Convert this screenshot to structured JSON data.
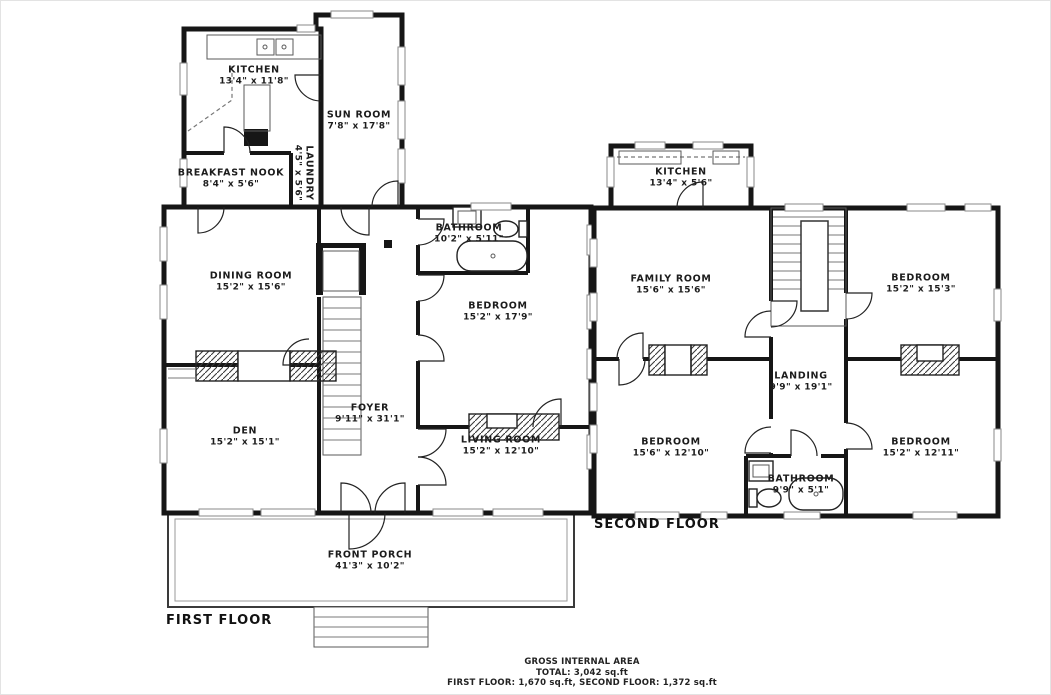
{
  "first_floor": {
    "label": "FIRST FLOOR",
    "rooms": [
      {
        "name": "KITCHEN",
        "dims": "13'4\" x 11'8\""
      },
      {
        "name": "SUN ROOM",
        "dims": "7'8\" x 17'8\""
      },
      {
        "name": "BREAKFAST NOOK",
        "dims": "8'4\" x 5'6\""
      },
      {
        "name": "LAUNDRY",
        "dims": "4'5\" x 5'6\""
      },
      {
        "name": "DINING ROOM",
        "dims": "15'2\" x 15'6\""
      },
      {
        "name": "BATHROOM",
        "dims": "10'2\" x 5'11\""
      },
      {
        "name": "BEDROOM",
        "dims": "15'2\" x 17'9\""
      },
      {
        "name": "DEN",
        "dims": "15'2\" x 15'1\""
      },
      {
        "name": "FOYER",
        "dims": "9'11\" x 31'1\""
      },
      {
        "name": "LIVING ROOM",
        "dims": "15'2\" x 12'10\""
      },
      {
        "name": "FRONT PORCH",
        "dims": "41'3\" x 10'2\""
      }
    ]
  },
  "second_floor": {
    "label": "SECOND FLOOR",
    "rooms": [
      {
        "name": "KITCHEN",
        "dims": "13'4\" x 5'6\""
      },
      {
        "name": "FAMILY ROOM",
        "dims": "15'6\" x 15'6\""
      },
      {
        "name": "BEDROOM",
        "dims": "15'2\" x 15'3\""
      },
      {
        "name": "LANDING",
        "dims": "9'9\" x 19'1\""
      },
      {
        "name": "BEDROOM",
        "dims": "15'6\" x 12'10\""
      },
      {
        "name": "BATHROOM",
        "dims": "9'9\" x 5'1\""
      },
      {
        "name": "BEDROOM",
        "dims": "15'2\" x 12'11\""
      }
    ]
  },
  "footer": {
    "line1": "GROSS INTERNAL AREA",
    "line2": "TOTAL: 3,042 sq.ft",
    "line3": "FIRST FLOOR: 1,670 sq.ft, SECOND FLOOR: 1,372 sq.ft"
  },
  "colors": {
    "wall": "#161616",
    "window": "#8a8a8a",
    "text": "#1c1c1c"
  }
}
